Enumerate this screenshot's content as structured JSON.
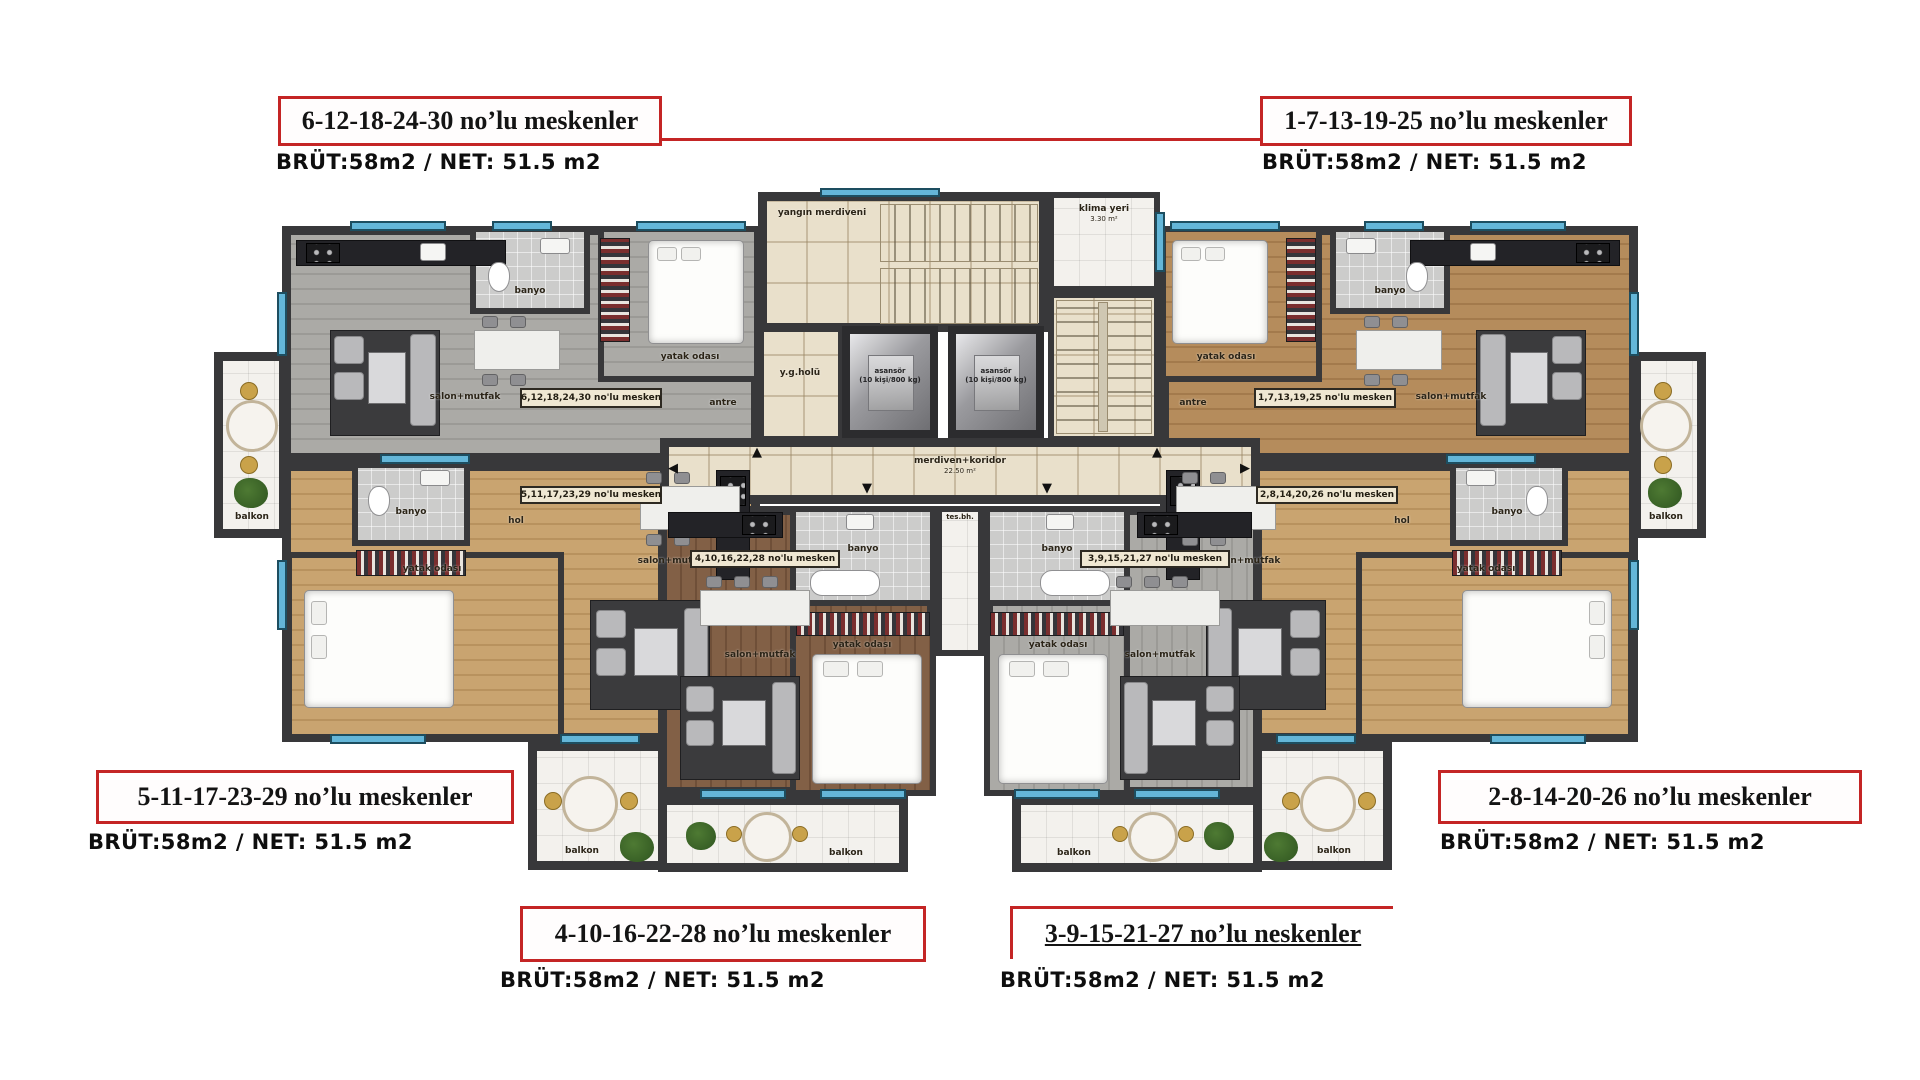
{
  "annotations": {
    "boxes": [
      {
        "id": "top-left",
        "title": "6-12-18-24-30 no’lu meskenler",
        "area": "BRÜT:58m2 / NET: 51.5 m2"
      },
      {
        "id": "top-right",
        "title": "1-7-13-19-25 no’lu meskenler",
        "area": "BRÜT:58m2 / NET: 51.5 m2"
      },
      {
        "id": "bottom-left",
        "title": "5-11-17-23-29 no’lu meskenler",
        "area": "BRÜT:58m2 / NET: 51.5 m2"
      },
      {
        "id": "bottom-right",
        "title": "2-8-14-20-26 no’lu meskenler",
        "area": "BRÜT:58m2 / NET: 51.5 m2"
      },
      {
        "id": "bottom-center-left",
        "title": "4-10-16-22-28 no’lu meskenler",
        "area": "BRÜT:58m2 / NET: 51.5 m2"
      },
      {
        "id": "bottom-center-right",
        "title": "3-9-15-21-27 no’lu neskenler",
        "area": "BRÜT:58m2 / NET: 51.5 m2"
      }
    ]
  },
  "plan": {
    "core": {
      "fire_stairs_label": "yangın merdiveni",
      "fire_hall_label": "y.g.holü",
      "klima_label": "klima yeri",
      "klima_area": "3.30 m²",
      "elevator_label": "asansör",
      "elevator_capacity": "(10 kişi/800 kg)",
      "corridor_label": "merdiven+koridor",
      "corridor_area": "22.50 m²",
      "shaft_label": "tes.bh."
    },
    "room_labels": {
      "living": "salon+mutfak",
      "bedroom": "yatak odası",
      "bath": "banyo",
      "hall": "hol",
      "entry": "antre",
      "balcony": "balkon"
    },
    "unit_tags": {
      "tl": "6,12,18,24,30 no'lu mesken",
      "tr": "1,7,13,19,25 no'lu mesken",
      "bl": "5,11,17,23,29 no'lu mesken",
      "br": "2,8,14,20,26 no'lu mesken",
      "bcl": "4,10,16,22,28 no'lu mesken",
      "bcr": "3,9,15,21,27 no'lu mesken"
    },
    "colors": {
      "wall": "#38383a",
      "window": "#64b6d8",
      "annotation_red": "#c42525",
      "floor_gray": "#a6a5a1",
      "floor_wood_light": "#c9a470",
      "floor_wood_mid": "#b58c5c",
      "floor_wood_dark": "#826046",
      "marble": "#e9e0cb",
      "balcony_tile": "#f3f1ed"
    }
  }
}
